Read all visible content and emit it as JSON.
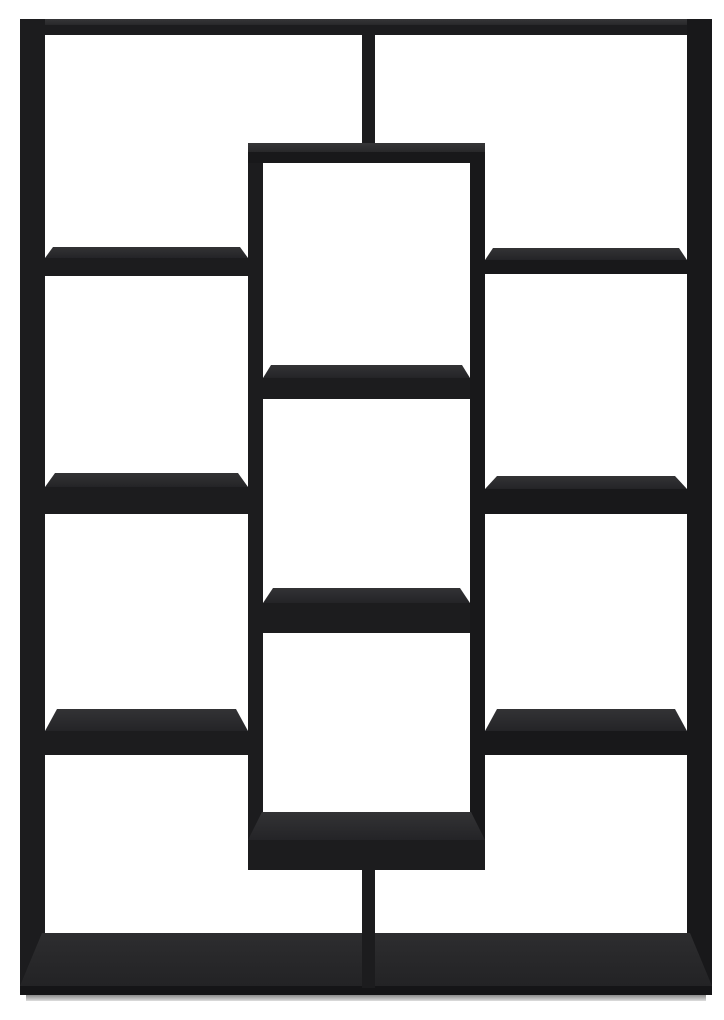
{
  "image": {
    "description": "Studio product photo of a black open-back geometric bookcase / display shelf with offset cube compartments, viewed frontally on a plain white background",
    "background_color": "#ffffff",
    "product_color_name": "black",
    "palette": {
      "black_face": "#1c1c1e",
      "black_shade": "#18181a",
      "top_surface": [
        "#333335",
        "#242427"
      ],
      "cap_top": [
        "#363638",
        "#28282a"
      ],
      "band_top": [
        "#2d2d2f",
        "#232325"
      ],
      "band_face": "#151517",
      "floor_shadow": [
        "#8a8a8a",
        "#dedede"
      ]
    }
  },
  "shelf": {
    "panels": [
      {
        "name": "top-panel-top-surface",
        "x": 20,
        "y": 19,
        "w": 692,
        "h": 6,
        "tone": "cap_top"
      },
      {
        "name": "top-panel-face",
        "x": 20,
        "y": 25,
        "w": 692,
        "h": 10,
        "tone": "black_face"
      },
      {
        "name": "left-upright",
        "x": 20,
        "y": 19,
        "w": 25,
        "h": 975,
        "tone": "black_face"
      },
      {
        "name": "right-upright",
        "x": 687,
        "y": 19,
        "w": 25,
        "h": 975,
        "tone": "black_shade"
      },
      {
        "name": "top-center-divider",
        "x": 362,
        "y": 30,
        "w": 13,
        "h": 121,
        "tone": "black_face"
      },
      {
        "name": "middle-left-wall",
        "x": 248,
        "y": 145,
        "w": 15,
        "h": 725,
        "tone": "black_face"
      },
      {
        "name": "middle-right-wall",
        "x": 470,
        "y": 145,
        "w": 15,
        "h": 725,
        "tone": "black_shade"
      },
      {
        "name": "middle-box-top-surface",
        "x": 248,
        "y": 143,
        "w": 237,
        "h": 9,
        "tone": "cap_top"
      },
      {
        "name": "middle-box-top-face",
        "x": 248,
        "y": 152,
        "w": 237,
        "h": 11,
        "tone": "black_shade"
      },
      {
        "name": "left-shelf-1-top",
        "x": 45,
        "y": 247,
        "w": 203,
        "h": 11,
        "tone": "top_surface",
        "trap": 8
      },
      {
        "name": "left-shelf-1-face",
        "x": 45,
        "y": 258,
        "w": 203,
        "h": 18,
        "tone": "black_face"
      },
      {
        "name": "right-shelf-1-top",
        "x": 485,
        "y": 248,
        "w": 202,
        "h": 12,
        "tone": "top_surface",
        "trap": 8
      },
      {
        "name": "right-shelf-1-face",
        "x": 485,
        "y": 260,
        "w": 202,
        "h": 14,
        "tone": "black_shade"
      },
      {
        "name": "middle-shelf-upper-top",
        "x": 263,
        "y": 365,
        "w": 207,
        "h": 13,
        "tone": "top_surface",
        "trap": 8
      },
      {
        "name": "middle-shelf-upper-face",
        "x": 263,
        "y": 378,
        "w": 207,
        "h": 21,
        "tone": "black_face"
      },
      {
        "name": "left-shelf-2-top",
        "x": 45,
        "y": 473,
        "w": 203,
        "h": 14,
        "tone": "top_surface",
        "trap": 10
      },
      {
        "name": "left-shelf-2-face",
        "x": 45,
        "y": 487,
        "w": 203,
        "h": 27,
        "tone": "black_face"
      },
      {
        "name": "right-shelf-2-top",
        "x": 485,
        "y": 476,
        "w": 202,
        "h": 13,
        "tone": "top_surface",
        "trap": 12
      },
      {
        "name": "right-shelf-2-face",
        "x": 485,
        "y": 489,
        "w": 202,
        "h": 25,
        "tone": "black_shade"
      },
      {
        "name": "middle-shelf-lower-top",
        "x": 263,
        "y": 588,
        "w": 207,
        "h": 15,
        "tone": "top_surface",
        "trap": 10
      },
      {
        "name": "middle-shelf-lower-face",
        "x": 263,
        "y": 603,
        "w": 207,
        "h": 30,
        "tone": "black_face"
      },
      {
        "name": "left-shelf-3-top",
        "x": 45,
        "y": 709,
        "w": 203,
        "h": 22,
        "tone": "top_surface",
        "trap": 12
      },
      {
        "name": "left-shelf-3-face",
        "x": 45,
        "y": 731,
        "w": 203,
        "h": 24,
        "tone": "black_face"
      },
      {
        "name": "right-shelf-3-top",
        "x": 485,
        "y": 709,
        "w": 202,
        "h": 22,
        "tone": "top_surface",
        "trap": 12
      },
      {
        "name": "right-shelf-3-face",
        "x": 485,
        "y": 731,
        "w": 202,
        "h": 24,
        "tone": "black_shade"
      },
      {
        "name": "middle-box-bottom-top",
        "x": 248,
        "y": 812,
        "w": 237,
        "h": 28,
        "tone": "top_surface",
        "trap": 14
      },
      {
        "name": "middle-box-bottom-face",
        "x": 248,
        "y": 840,
        "w": 237,
        "h": 30,
        "tone": "black_face"
      },
      {
        "name": "bottom-panel-top-surface",
        "x": 20,
        "y": 933,
        "w": 692,
        "h": 53,
        "tone": "band_top",
        "trap": 22
      },
      {
        "name": "bottom-panel-face",
        "x": 20,
        "y": 986,
        "w": 692,
        "h": 9,
        "tone": "band_face"
      },
      {
        "name": "bottom-center-divider",
        "x": 362,
        "y": 866,
        "w": 13,
        "h": 122,
        "tone": "black_face"
      },
      {
        "name": "floor-shadow",
        "x": 26,
        "y": 995,
        "w": 680,
        "h": 6,
        "tone": "floor_shadow"
      }
    ]
  }
}
